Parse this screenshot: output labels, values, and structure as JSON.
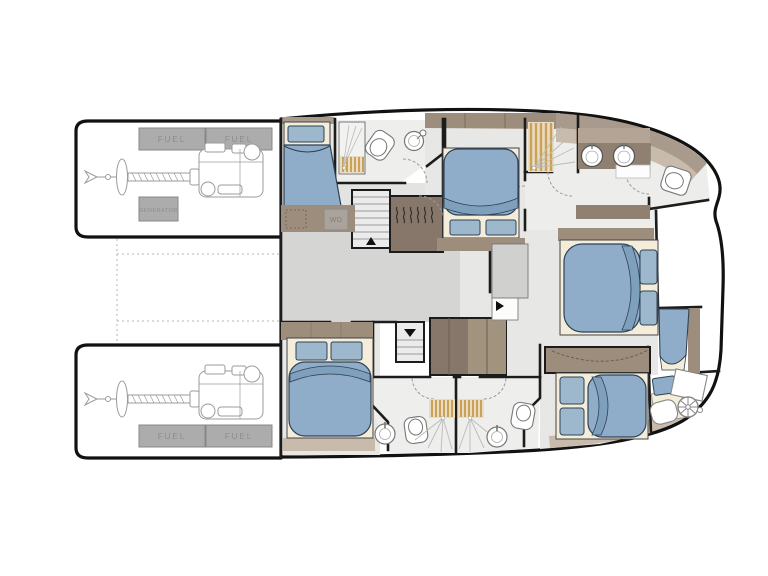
{
  "labels": {
    "fuel": "FUEL",
    "generator": "GENERATOR",
    "washer_dryer": "WD"
  },
  "colors": {
    "background": "#ffffff",
    "hull_outline": "#111111",
    "wall": "#1c1c1c",
    "floor_corridor": "#d5d5d4",
    "floor_cabin": "#e7e7e5",
    "floor_bathroom": "#eeeeec",
    "cabinet_dark": "#87776a",
    "cabinet_medium": "#9c8d7d",
    "trim_light": "#c9bbab",
    "trim_dark": "#a89a8c",
    "bed_base_cream": "#f3edda",
    "duvet_blue": "#8fadc8",
    "duvet_fold_blue": "#7fa0bd",
    "pillow_blue": "#9db7cd",
    "teak_grate": "#c9a257",
    "equipment_box_gray": "#acacac",
    "engine_line_gray": "#9b9b9b",
    "dashed_guide_gray": "#b5b5b5"
  }
}
